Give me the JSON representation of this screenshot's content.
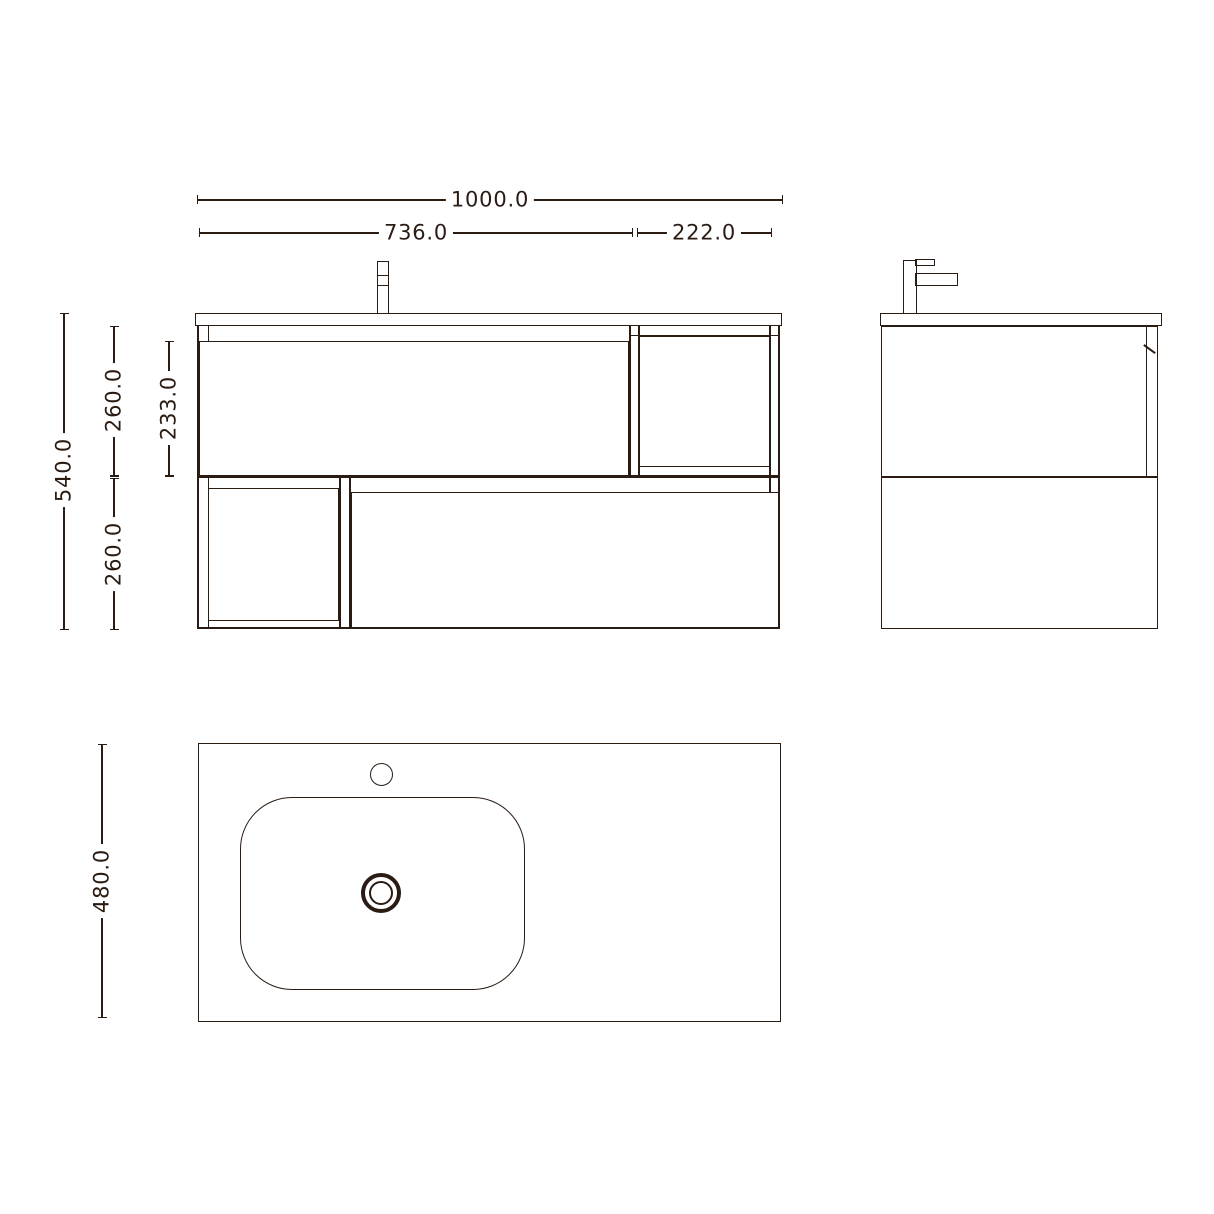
{
  "style": {
    "line_color": "#2a1b13",
    "background_color": "#ffffff"
  },
  "front_view": {
    "dim_total_width": "1000.0",
    "dim_drawer_width": "736.0",
    "dim_shelf_width": "222.0",
    "dim_total_height": "540.0",
    "dim_upper_height": "260.0",
    "dim_drawer_face_height": "233.0",
    "dim_lower_height": "260.0"
  },
  "top_view": {
    "dim_depth": "480.0"
  }
}
